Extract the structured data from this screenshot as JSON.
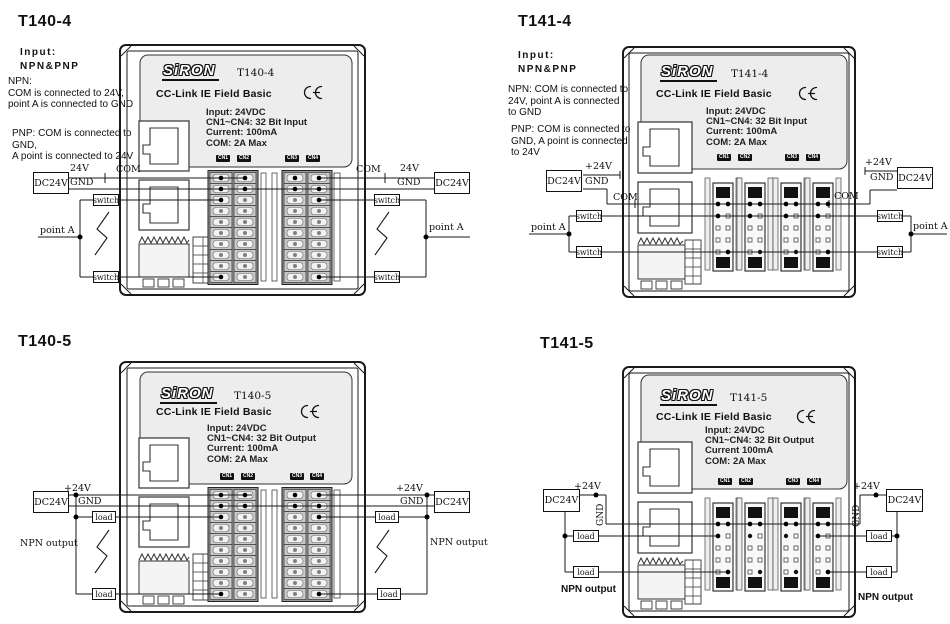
{
  "sheet_background": "#ffffff",
  "line_color": "#1a1a1a",
  "diagrams": [
    {
      "title": "T140-4",
      "notes": {
        "input_label": "Input:",
        "input_value": "NPN&PNP",
        "npn": "NPN:\nCOM is connected to 24V,\npoint A is connected to GND",
        "pnp": "PNP: COM is connected to\nGND,\nA point is connected to 24V"
      },
      "module": {
        "brand": "SiRON",
        "model": "T140-4",
        "bus": "CC-Link IE Field Basic",
        "specs": "Input: 24VDC\nCN1~CN4:  32 Bit Input\nCurrent:  100mA\nCOM:  2A Max",
        "cn": [
          "CN1",
          "CN2",
          "CN3",
          "CN4"
        ]
      },
      "wiring": {
        "supply": "DC24V",
        "rail_pos": "24V",
        "rail_neg": "GND",
        "com": "COM",
        "device": "switch",
        "point": "point A"
      }
    },
    {
      "title": "T141-4",
      "notes": {
        "input_label": "Input:",
        "input_value": "NPN&PNP",
        "npn": "NPN: COM is connected to\n24V, point A is connected\nto GND",
        "pnp": "PNP: COM is connected to\nGND, A point is connected\nto 24V"
      },
      "module": {
        "brand": "SiRON",
        "model": "T141-4",
        "bus": "CC-Link IE Field Basic",
        "specs": "Input: 24VDC\nCN1~CN4:  32 Bit Input\nCurrent:  100mA\nCOM:  2A Max",
        "cn": [
          "CN1",
          "CN2",
          "CN3",
          "CN4"
        ]
      },
      "wiring": {
        "supply": "DC24V",
        "rail_pos": "+24V",
        "rail_neg": "GND",
        "com": "COM",
        "device": "switch",
        "point": "point A"
      }
    },
    {
      "title": "T140-5",
      "module": {
        "brand": "SiRON",
        "model": "T140-5",
        "bus": "CC-Link IE Field Basic",
        "specs": "Input: 24VDC\nCN1~CN4:  32 Bit Output\nCurrent:  100mA\nCOM:  2A Max",
        "cn": [
          "CN1",
          "CN2",
          "CN3",
          "CN4"
        ]
      },
      "wiring": {
        "supply": "DC24V",
        "rail_pos": "+24V",
        "rail_neg": "GND",
        "device": "load",
        "output_label": "NPN output"
      }
    },
    {
      "title": "T141-5",
      "module": {
        "brand": "SiRON",
        "model": "T141-5",
        "bus": "CC-Link IE Field Basic",
        "specs": "Input: 24VDC\nCN1~CN4:  32 Bit Output\nCurrent  100mA\nCOM:  2A Max",
        "cn": [
          "CN1",
          "CN2",
          "CN3",
          "CN4"
        ]
      },
      "wiring": {
        "supply": "DC24V",
        "rail_pos": "+24V",
        "rail_neg": "GND",
        "device": "load",
        "output_label": "NPN output"
      }
    }
  ]
}
